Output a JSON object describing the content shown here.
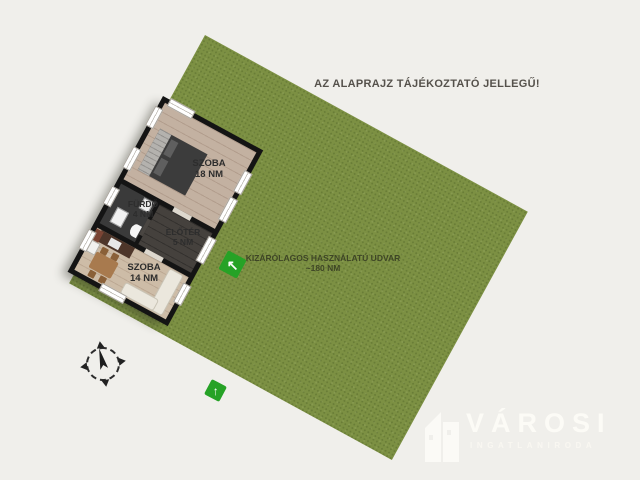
{
  "disclaimer": "AZ ALAPRAJZ TÁJÉKOZTATÓ JELLEGŰ!",
  "yard": {
    "label": "KIZÁRÓLAGOS HASZNÁLATÚ UDVAR",
    "area": "~180 NM"
  },
  "rooms": {
    "szoba18": {
      "name": "SZOBA",
      "area": "18 NM"
    },
    "furdo": {
      "name": "FÜRDŐ",
      "area": "4 NM"
    },
    "eloter": {
      "name": "ELŐTÉR",
      "area": "5 NM"
    },
    "szoba14": {
      "name": "SZOBA",
      "area": "14 NM"
    }
  },
  "markers": {
    "entrance_glyph": "↖",
    "yard_glyph": "↑"
  },
  "logo": {
    "brand": "VÁROSI",
    "subtitle": "INGATLANIRODA"
  },
  "colors": {
    "background": "#f0efeb",
    "grass": "#7c9043",
    "marker_green": "#26a226",
    "wall": "#141414",
    "wood_floor": "#c3b1a1",
    "wood_floor_light": "#cdbca7",
    "dark_floor": "#3a3a3a",
    "label_text": "#2d2d2d"
  }
}
